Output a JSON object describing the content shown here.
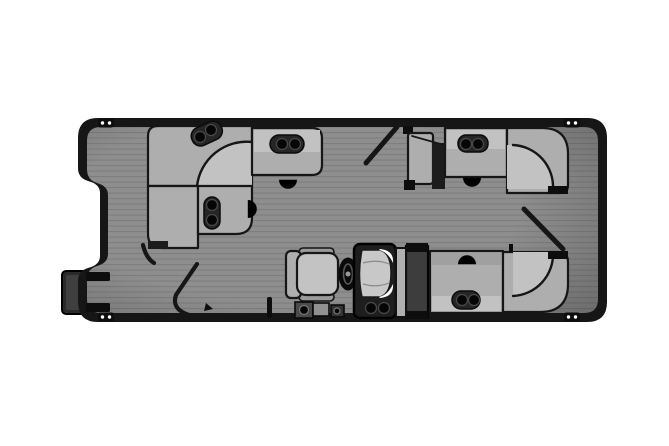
{
  "title": "Pontoon boat floor plan, top-down deck layout",
  "colors": {
    "page_bg": "#ffffff",
    "hull": "#161616",
    "deck": "#8e8e8e",
    "plank": "#7e7e7e",
    "seat": "#aeaeae",
    "seat_light": "#c2c2c2",
    "seat_dark": "#a0a0a0",
    "outline": "#161616",
    "fixture": "#262626",
    "cupholder": "#060606",
    "block": "#3d3d3d",
    "console": "#1e1e1e",
    "windshield": "#c8c8c8",
    "platform": "#2a2a2a"
  },
  "features": {
    "cleat_count": 4,
    "speaker_count": 4,
    "cupholder_count": 12,
    "gate_count": 3,
    "areas": [
      {
        "name": "bow-lounge",
        "description": "L-shaped wraparound lounge with curved corner seat, forward"
      },
      {
        "name": "midship-lounge",
        "description": "L-shaped lounge with curved corner seat, upper aft"
      },
      {
        "name": "aft-lounge",
        "description": "L-shaped lounge with curved corner seat, lower aft"
      },
      {
        "name": "helm",
        "description": "Captain's chair, steering wheel, console with windshield and cupholders"
      },
      {
        "name": "boarding-platform",
        "description": "Side boarding platform with gate opening"
      }
    ]
  }
}
